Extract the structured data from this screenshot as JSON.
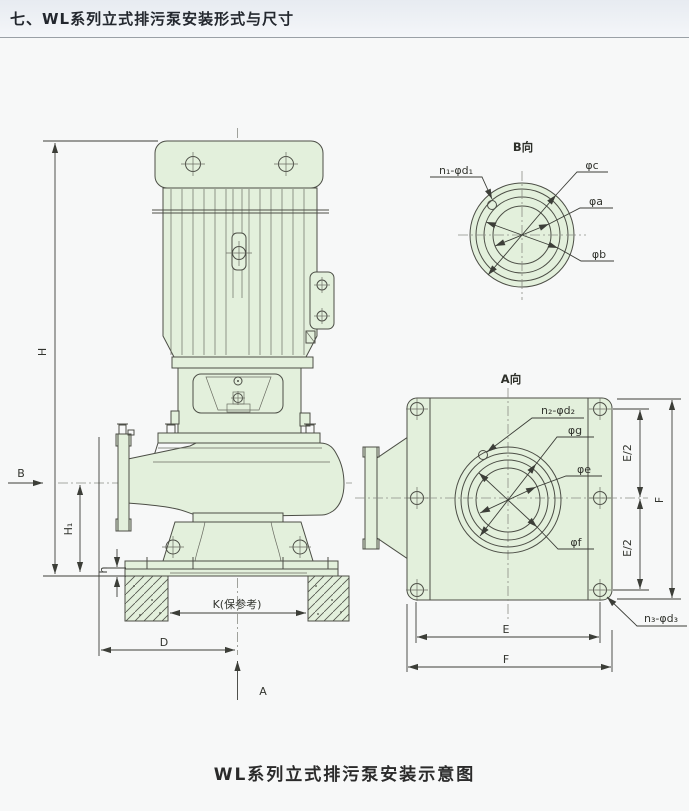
{
  "header": {
    "title": "七、WL系列立式排污泵安装形式与尺寸"
  },
  "caption": "WL系列立式排污泵安装示意图",
  "colors": {
    "drawing_fill_green": "#e3f0dc",
    "outline": "#4c4e46",
    "dimension_line": "#3c3e38",
    "header_rule": "#9aa0a6",
    "page_background": "#f7f8f8"
  },
  "side_view": {
    "dim_H": "H",
    "dim_H1": "H₁",
    "dim_h": "h",
    "dim_B": "B",
    "dim_A": "A",
    "dim_D": "D",
    "dim_K": "K(保参考)"
  },
  "view_b": {
    "title": "B向",
    "n1": "n₁-φd₁",
    "phi_c": "φc",
    "phi_a": "φa",
    "phi_b": "φb"
  },
  "view_a": {
    "title": "A向",
    "n2": "n₂-φd₂",
    "n3": "n₃-φd₃",
    "phi_g": "φg",
    "phi_e": "φe",
    "phi_f": "φf",
    "e_half_top": "E/2",
    "e_half_bottom": "E/2",
    "f_right": "F",
    "e_bottom": "E",
    "f_bottom": "F"
  }
}
